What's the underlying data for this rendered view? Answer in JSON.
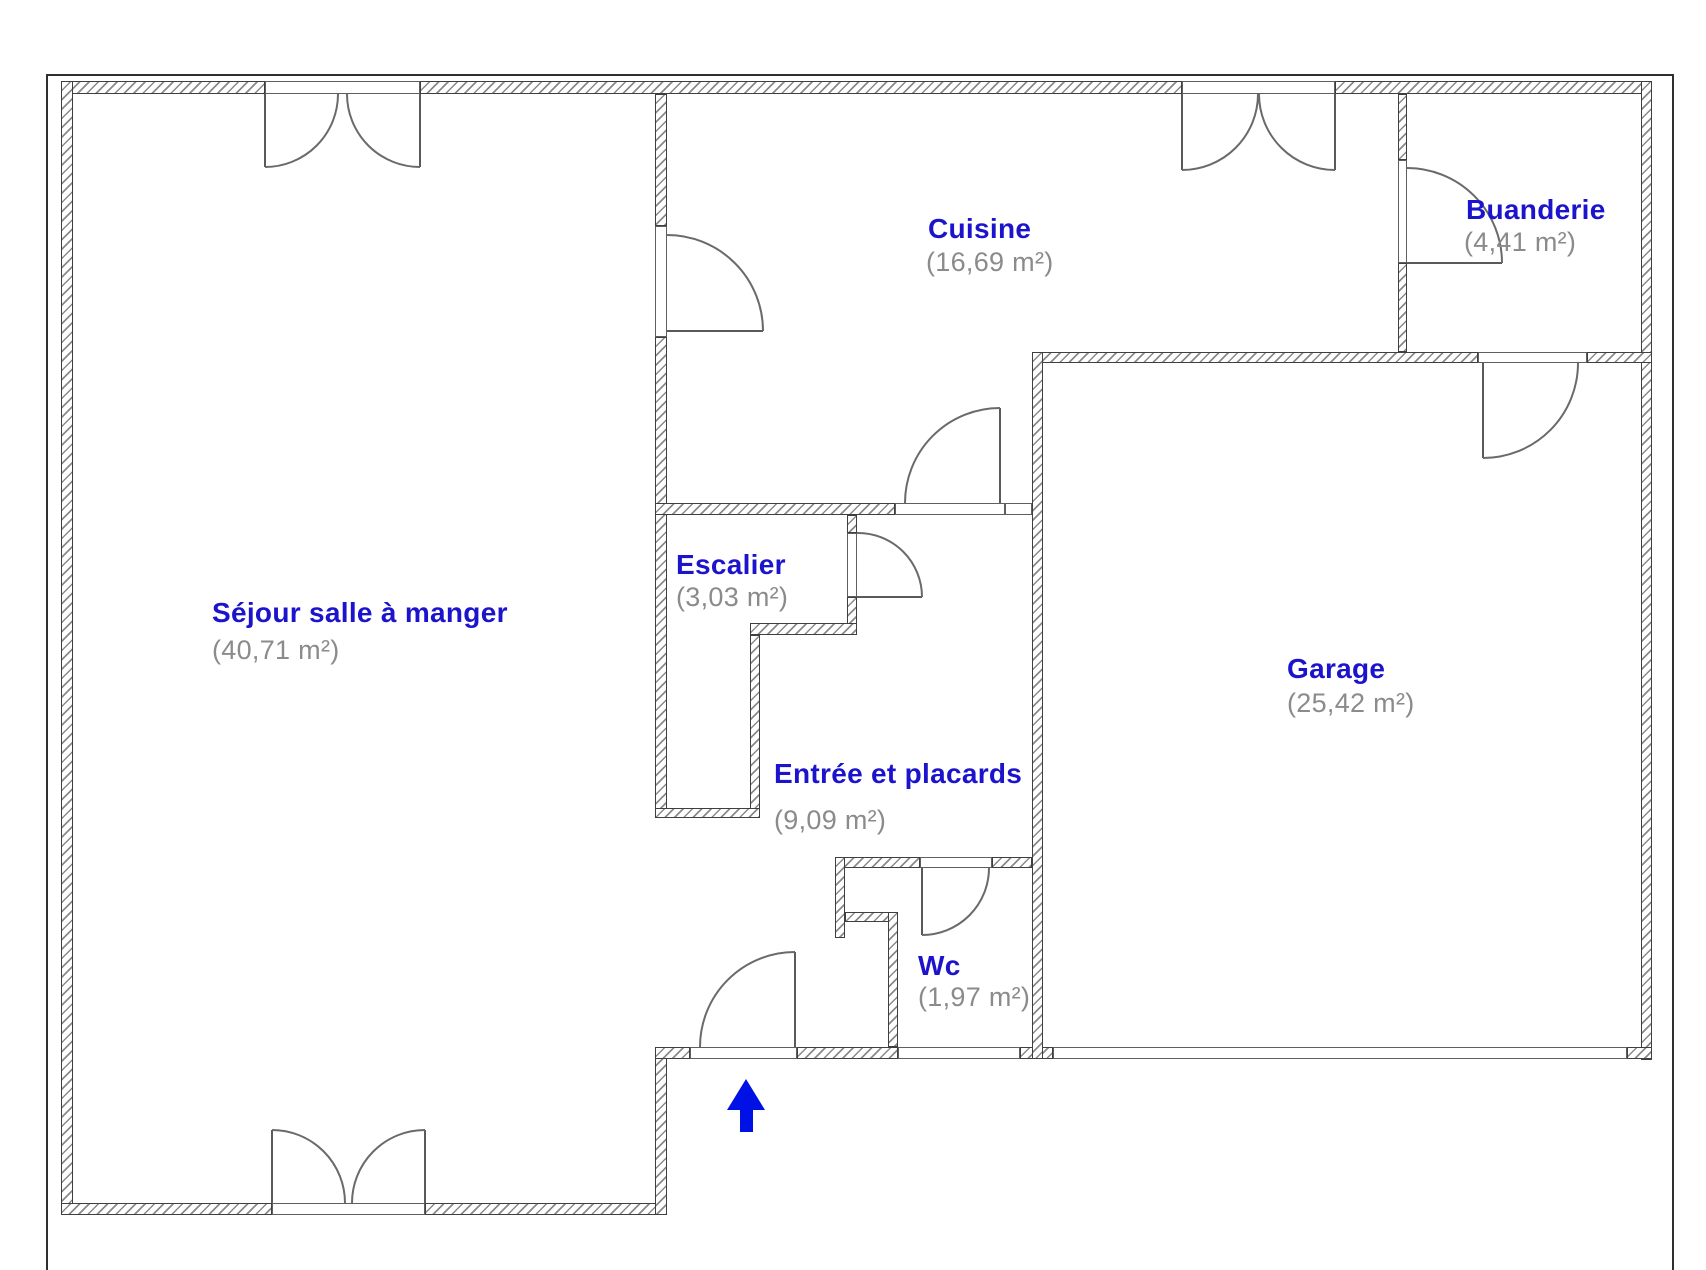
{
  "plan": {
    "type": "floor-plan",
    "language": "fr",
    "rooms": [
      {
        "id": "sejour",
        "name": "Séjour salle à manger",
        "area": "(40,71 m²)"
      },
      {
        "id": "cuisine",
        "name": "Cuisine",
        "area": "(16,69 m²)"
      },
      {
        "id": "buanderie",
        "name": "Buanderie",
        "area": "(4,41 m²)"
      },
      {
        "id": "escalier",
        "name": "Escalier",
        "area": "(3,03 m²)"
      },
      {
        "id": "entree",
        "name": "Entrée et placards",
        "area": "(9,09 m²)"
      },
      {
        "id": "garage",
        "name": "Garage",
        "area": "(25,42 m²)"
      },
      {
        "id": "wc",
        "name": "Wc",
        "area": "(1,97 m²)"
      }
    ],
    "icons": {
      "entrance_arrow": "up-arrow"
    },
    "colors": {
      "room_name": "#1b14cc",
      "room_area": "#8b8b8b",
      "arrow": "#0011e6",
      "wall_outline": "#3f3f3f",
      "wall_hatch": "#8a8a8a",
      "background": "#ffffff"
    }
  }
}
